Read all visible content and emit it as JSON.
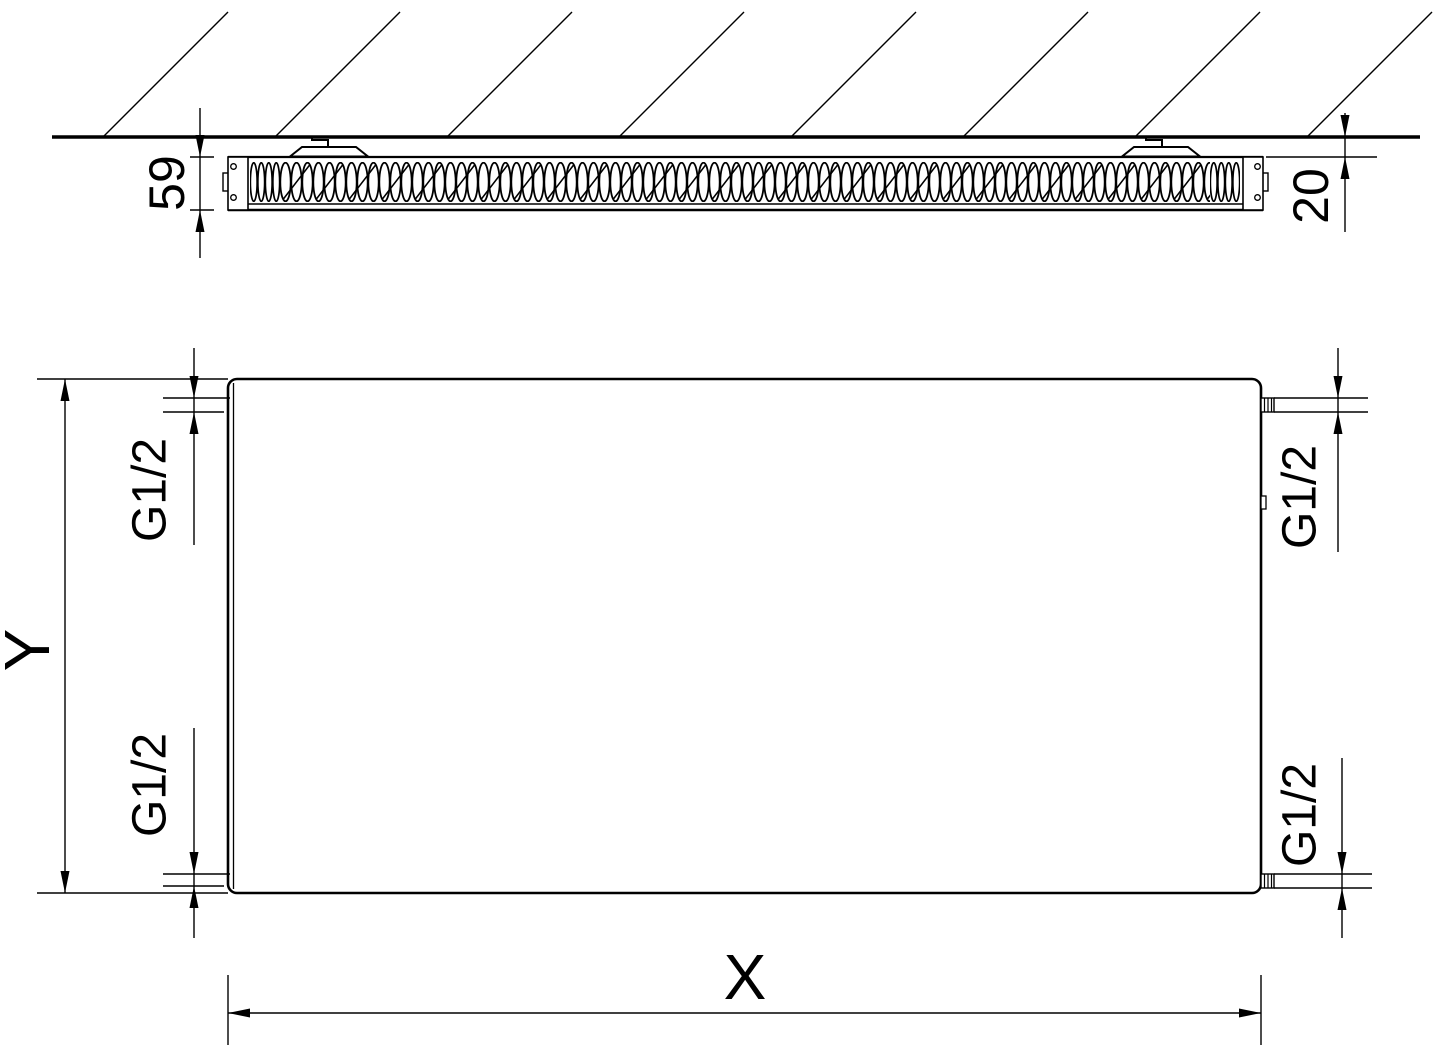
{
  "labels": {
    "depth": "59",
    "wall_clearance": "20",
    "height": "Y",
    "width": "X",
    "thread_top_left": "G1/2",
    "thread_top_right": "G1/2",
    "thread_bottom_left": "G1/2",
    "thread_bottom_right": "G1/2"
  },
  "colors": {
    "line": "#000000",
    "background": "#ffffff"
  }
}
